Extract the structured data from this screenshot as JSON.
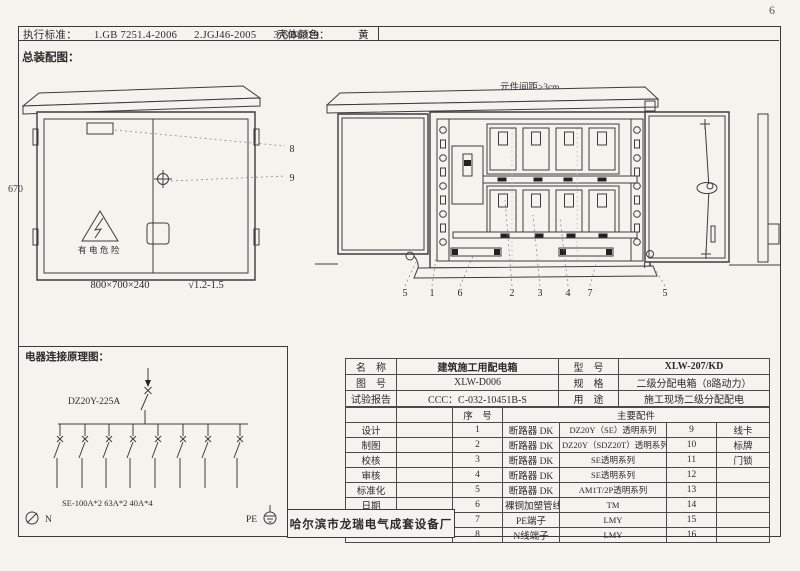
{
  "page_number": "6",
  "header": {
    "standards_label": "执行标准：",
    "standard_1": "1.GB 7251.4-2006",
    "standard_2": "2.JGJ46-2005",
    "standard_3": "3.GB6829",
    "shell_color_label": "壳体颜色：",
    "shell_color_value": "黄"
  },
  "assembly": {
    "section_title": "总装配图：",
    "height_dim": "670",
    "box_dim": "800×700×240",
    "finish": "√1.2-1.5",
    "warning_text": "有电危险",
    "spacing_note": "元件间距≥3cm",
    "callout_8": "8",
    "callout_9": "9",
    "open_callouts": [
      "5",
      "1",
      "6",
      "2",
      "3",
      "4",
      "7",
      "5"
    ]
  },
  "schematic": {
    "section_title": "电器连接原理图：",
    "main_breaker": "DZ20Y-225A",
    "branch_spec": "SE-100A*2 63A*2 40A*4",
    "neutral_label": "N",
    "pe_label": "PE"
  },
  "spec_table": {
    "info_rows": [
      {
        "label": "名　称",
        "value": "建筑施工用配电箱",
        "label2": "型　号",
        "value2": "XLW-207/KD"
      },
      {
        "label": "图　号",
        "value": "XLW-D006",
        "label2": "规　格",
        "value2": "二级分配电箱（8路动力）"
      },
      {
        "label": "试验报告",
        "value": "CCC：C-032-10451B-S",
        "label2": "用　途",
        "value2": "施工现场二级分配配电"
      }
    ],
    "index_header": "序　号",
    "parts_header": "主要配件",
    "rows": [
      {
        "role": "设计",
        "no": "1",
        "part": "断路器 DK",
        "spec": "DZ20Y（SE）透明系列",
        "no2": "9",
        "part2": "线卡"
      },
      {
        "role": "制图",
        "no": "2",
        "part": "断路器 DK",
        "spec": "DZ20Y（SDZ20T）透明系列",
        "no2": "10",
        "part2": "标牌"
      },
      {
        "role": "校核",
        "no": "3",
        "part": "断路器 DK",
        "spec": "SE透明系列",
        "no2": "11",
        "part2": "门锁"
      },
      {
        "role": "审核",
        "no": "4",
        "part": "断路器 DK",
        "spec": "SE透明系列",
        "no2": "12",
        "part2": ""
      },
      {
        "role": "标准化",
        "no": "5",
        "part": "断路器 DK",
        "spec": "AM1T/2P透明系列",
        "no2": "13",
        "part2": ""
      },
      {
        "role": "日期",
        "no": "6",
        "part": "裸铜加塑管线",
        "spec": "TM",
        "no2": "14",
        "part2": ""
      },
      {
        "role": "",
        "no": "7",
        "part": "PE端子",
        "spec": "LMY",
        "no2": "15",
        "part2": ""
      },
      {
        "role": "",
        "no": "8",
        "part": "N线端子",
        "spec": "LMY",
        "no2": "16",
        "part2": ""
      }
    ],
    "company": "哈尔滨市龙瑞电气成套设备厂"
  }
}
